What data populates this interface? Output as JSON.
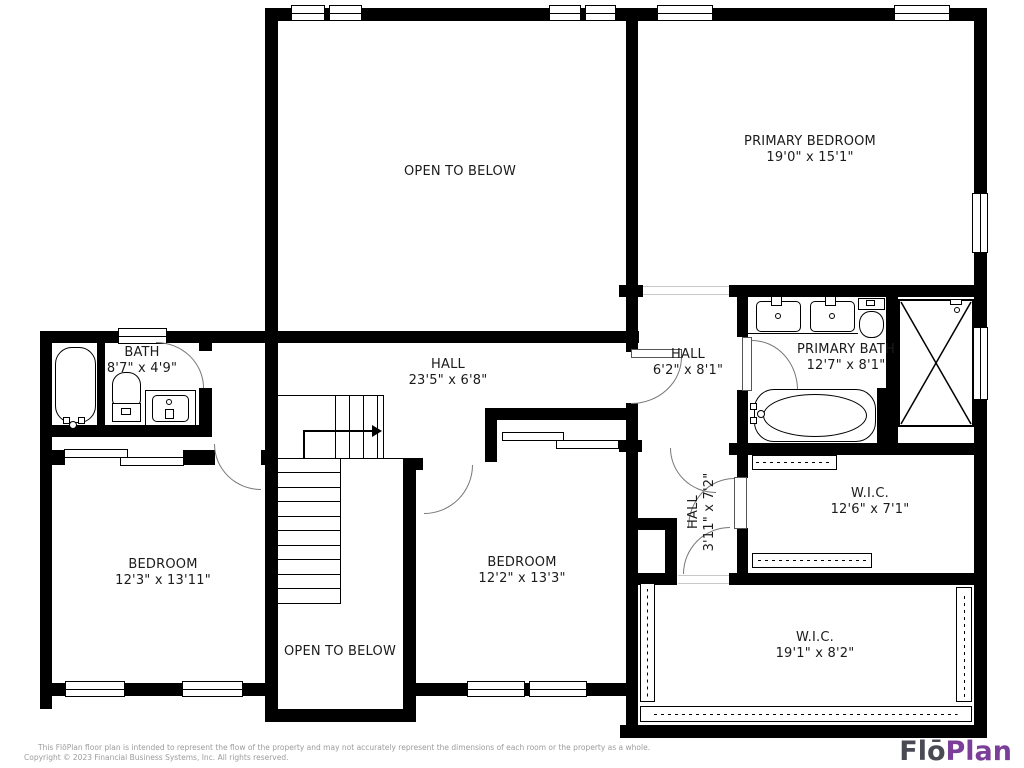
{
  "rooms": {
    "otb_upper": {
      "name": "OPEN TO BELOW",
      "dims": ""
    },
    "primary_bedroom": {
      "name": "PRIMARY BEDROOM",
      "dims": "19'0\" x 15'1\""
    },
    "bath": {
      "name": "BATH",
      "dims": "8'7\" x 4'9\""
    },
    "hall_main": {
      "name": "HALL",
      "dims": "23'5\" x 6'8\""
    },
    "hall_upper": {
      "name": "HALL",
      "dims": "6'2\" x 8'1\""
    },
    "primary_bath": {
      "name": "PRIMARY BATH",
      "dims": "12'7\" x 8'1\""
    },
    "bedroom_left": {
      "name": "BEDROOM",
      "dims": "12'3\" x 13'11\""
    },
    "bedroom_center": {
      "name": "BEDROOM",
      "dims": "12'2\" x 13'3\""
    },
    "hall_small": {
      "name": "HALL",
      "dims": "3'11\" x 7'2\""
    },
    "wic_upper": {
      "name": "W.I.C.",
      "dims": "12'6\" x 7'1\""
    },
    "otb_lower": {
      "name": "OPEN TO BELOW",
      "dims": ""
    },
    "wic_lower": {
      "name": "W.I.C.",
      "dims": "19'1\" x 8'2\""
    }
  },
  "footer": {
    "line1": "This FlōPlan floor plan is intended to represent the flow of the property and may not accurately represent the dimensions of each room or the property as a whole.",
    "line2": "Copyright © 2023 Financial Business Systems, Inc. All rights reserved."
  },
  "logo": {
    "part1": "Flō",
    "part2": "Plan",
    "color1": "#4a4a55",
    "color2": "#7b3f99"
  }
}
